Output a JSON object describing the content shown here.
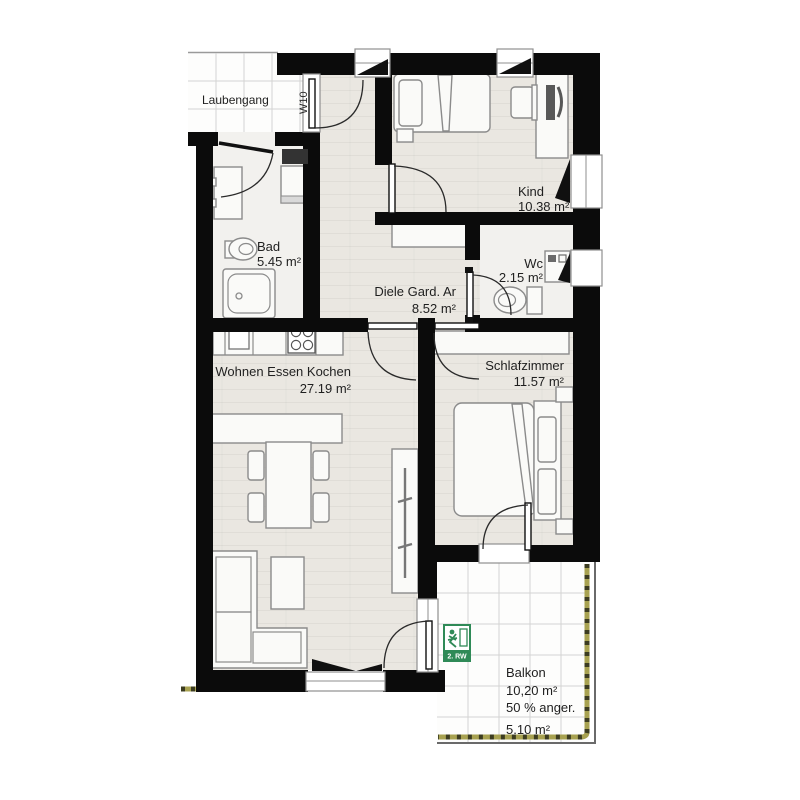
{
  "unit": {
    "label": "W10"
  },
  "rooms": {
    "laubengang": {
      "name": "Laubengang"
    },
    "kind": {
      "name": "Kind",
      "area": "10.38 m²"
    },
    "bad": {
      "name": "Bad",
      "area": "5.45 m²"
    },
    "wc": {
      "name": "Wc",
      "area": "2.15 m²"
    },
    "diele": {
      "name": "Diele Gard. Ar",
      "area": "8.52 m²"
    },
    "wohnen": {
      "name": "Wohnen Essen Kochen",
      "area": "27.19 m²"
    },
    "schlafzimmer": {
      "name": "Schlafzimmer",
      "area": "11.57 m²"
    },
    "balkon": {
      "name": "Balkon",
      "area": "10,20 m²",
      "note": "50 % anger.",
      "counted_area": "5.10 m²"
    }
  },
  "escape_route": {
    "label": "2. RW"
  },
  "colors": {
    "wall": "#0b0b0b",
    "floor": "#eae7e1",
    "wet_room_floor": "#f2f1ee",
    "railing_olive": "#a8a251",
    "escape_green": "#2f8a57"
  }
}
